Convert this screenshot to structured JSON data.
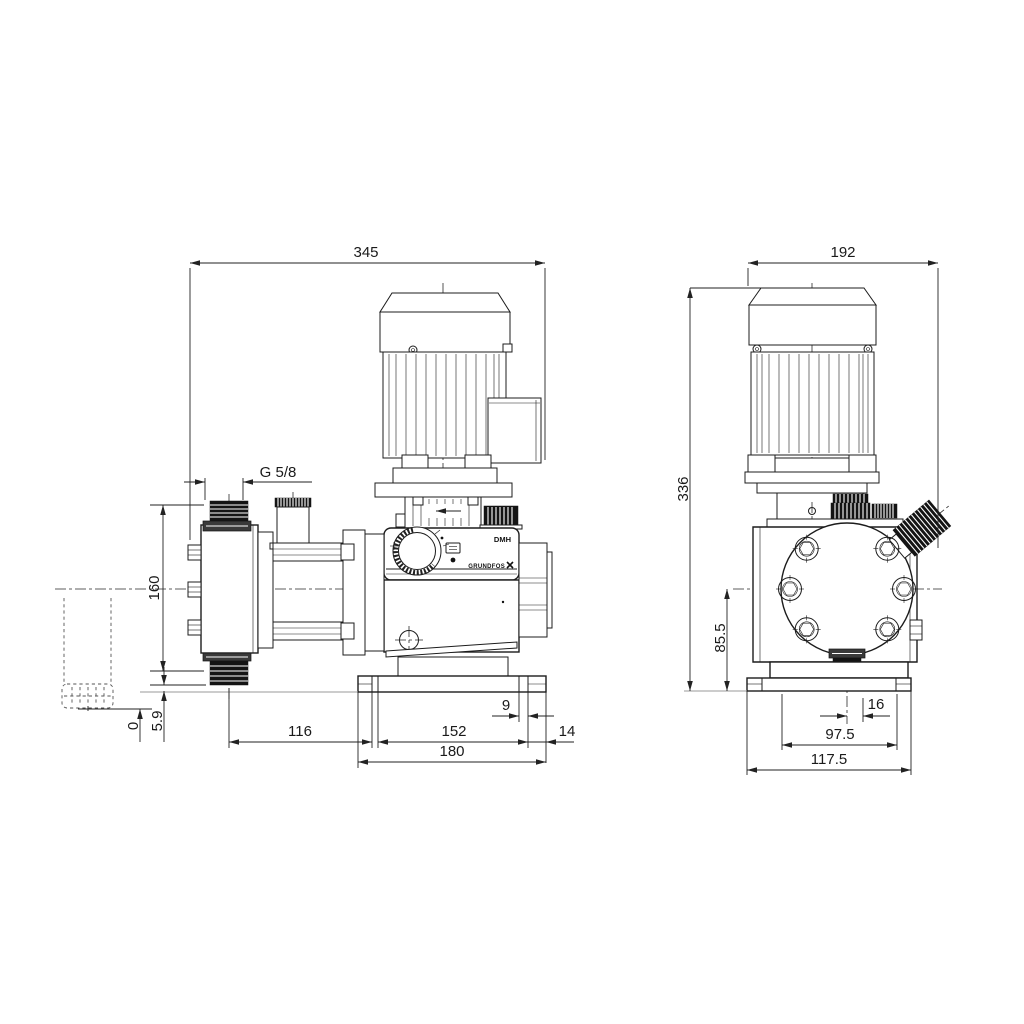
{
  "side_view": {
    "overall_length": "345",
    "thread_label": "G 5/8",
    "valve_span": "160",
    "clearance": "5.9",
    "ground_ref": "0",
    "center_to_slot": "116",
    "slot_span": "152",
    "slot_width": "9",
    "edge_offset": "14",
    "base_length": "180"
  },
  "front_view": {
    "overall_depth": "192",
    "overall_height": "336",
    "axis_height": "85.5",
    "valve_offset": "16",
    "slot_span": "97.5",
    "base_width": "117.5"
  },
  "labels": {
    "model": "DMH",
    "brand": "GRUNDFOS"
  },
  "colors": {
    "line": "#1c1c1c",
    "thread_fill": "#141414",
    "background": "#ffffff"
  }
}
